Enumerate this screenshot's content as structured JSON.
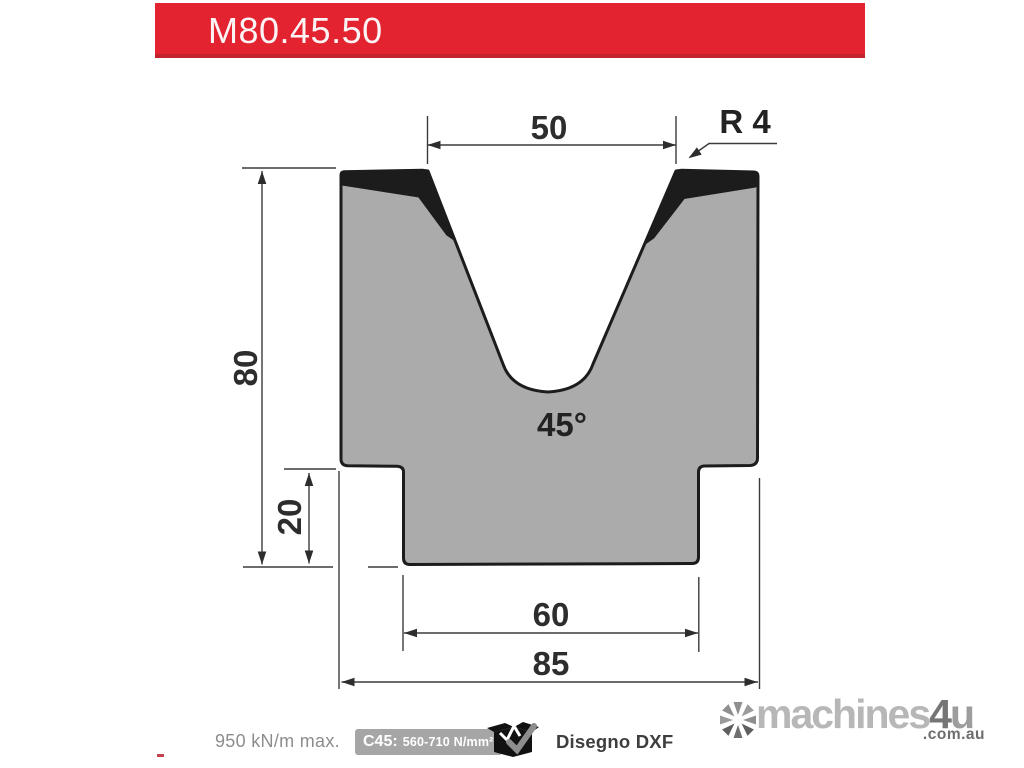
{
  "header": {
    "model": "M80.45.50",
    "banner_color": "#e42331"
  },
  "drawing": {
    "dims": {
      "top_width": "50",
      "radius": "R 4",
      "height": "80",
      "step_height": "20",
      "bottom_width": "60",
      "overall_width": "85",
      "angle": "45°"
    },
    "die_fill_color": "#ababab",
    "outline_color": "#1c1c1c"
  },
  "footer": {
    "max_load": "950 kN/m max.",
    "material_prefix": "C45:",
    "material_value": "560-710 N/mm²",
    "dxf_label": "Disegno DXF"
  },
  "watermark": {
    "brand_machines": "machines",
    "brand_4": "4",
    "brand_u": "u",
    "domain": ".com.au"
  },
  "misc": {
    "stray_mark": "-"
  }
}
